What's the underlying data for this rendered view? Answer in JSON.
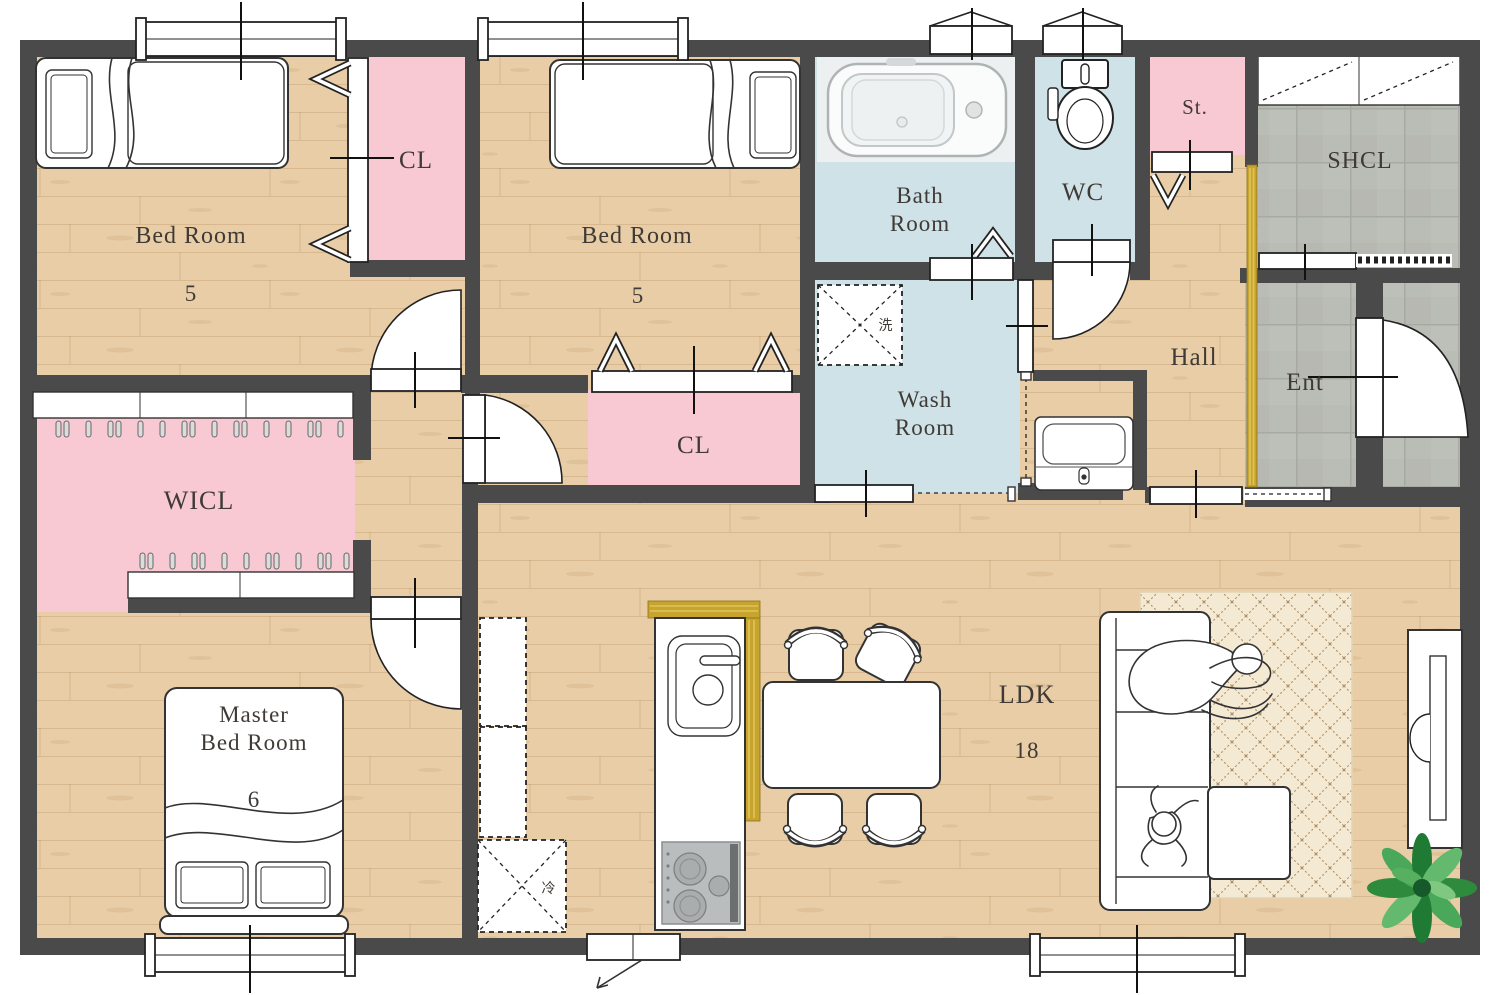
{
  "floor_plan": {
    "rooms": {
      "bedroom1": {
        "label": "Bed Room",
        "size": "5"
      },
      "bedroom2": {
        "label": "Bed Room",
        "size": "5"
      },
      "master_bedroom": {
        "label_line1": "Master",
        "label_line2": "Bed Room",
        "size": "6"
      },
      "ldk": {
        "label": "LDK",
        "size": "18"
      },
      "closet1": {
        "label": "CL"
      },
      "closet2": {
        "label": "CL"
      },
      "wicl": {
        "label": "WICL"
      },
      "bathroom": {
        "label_line1": "Bath",
        "label_line2": "Room"
      },
      "washroom": {
        "label_line1": "Wash",
        "label_line2": "Room"
      },
      "wc": {
        "label": "WC"
      },
      "storage": {
        "label": "St."
      },
      "shoe_closet": {
        "label": "SHCL"
      },
      "hall": {
        "label": "Hall"
      },
      "entrance": {
        "label": "Ent"
      }
    },
    "appliances": {
      "washer_label": "洗",
      "fridge_label": "冷"
    },
    "colors": {
      "wall": "#4a4a4a",
      "wood_floor": "#e8cda6",
      "closet_pink": "#f8c8d3",
      "water_blue": "#cfe2e8",
      "tile_gray": "#babdb6",
      "accent_gold": "#c7a42d",
      "rug_beige": "#f4e9d2",
      "plant_green": "#3c9a4e"
    }
  }
}
